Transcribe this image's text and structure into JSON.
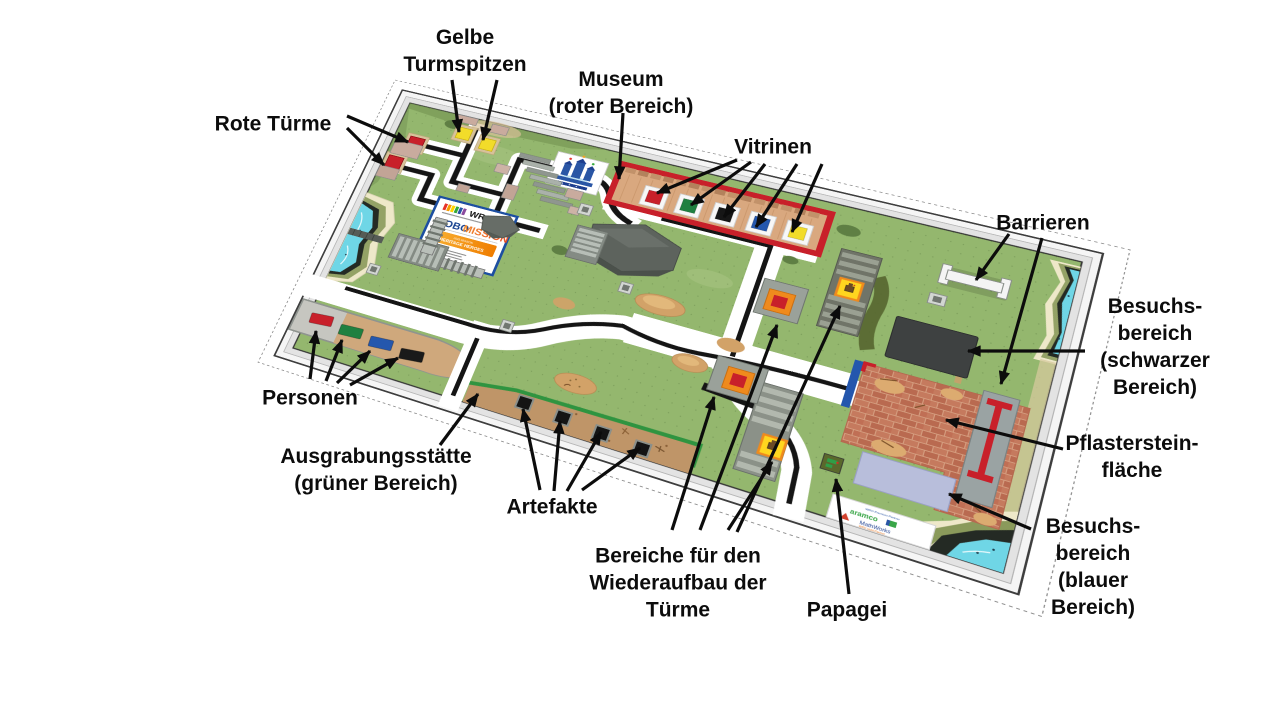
{
  "labels": {
    "rote_tuerme": "Rote Türme",
    "gelbe_turmspitzen": "Gelbe\nTurmspitzen",
    "museum": "Museum\n(roter Bereich)",
    "vitrinen": "Vitrinen",
    "barrieren": "Barrieren",
    "besuchsbereich_schwarz": "Besuchs-\nbereich\n(schwarzer\nBereich)",
    "pflastersteinflaeche": "Pflasterstein-\nfläche",
    "besuchsbereich_blau": "Besuchs-\nbereich\n(blauer\nBereich)",
    "personen": "Personen",
    "ausgrabungsstaette": "Ausgrabungsstätte\n(grüner Bereich)",
    "artefakte": "Artefakte",
    "wiederaufbau": "Bereiche für den\nWiederaufbau der\nTürme",
    "papagei": "Papagei"
  },
  "field_signs": {
    "wro_logo": "WRO",
    "robo": "ROBO",
    "mission": "MISSION",
    "season": "2025 SEASON",
    "theme": "HERITAGE HEROES",
    "partner_premium": "WRO Premium Partner",
    "aramco": "aramco",
    "mathworks": "MathWorks",
    "partner_gold": "WRO Gold Partner"
  },
  "colors": {
    "mat_green": "#94b76e",
    "museum_red": "#c8202a",
    "dig_border_green": "#2f9440",
    "visitor_black": "#3e4141",
    "visitor_blue_pad": "#b8bedb",
    "rebuild_orange": "#ef8a1d",
    "rebuild_yellow": "#ffd61f",
    "tower_red": "#c8202a",
    "spire_yellow": "#f2dc2a",
    "water_cyan": "#6fd6e6",
    "person_colors": [
      "#c8202a",
      "#1f8040",
      "#2457ad",
      "#1a1a1a"
    ],
    "vitrine_colors": [
      "#c8202a",
      "#1f8040",
      "#161616",
      "#2457ad",
      "#f2dc2a"
    ]
  }
}
